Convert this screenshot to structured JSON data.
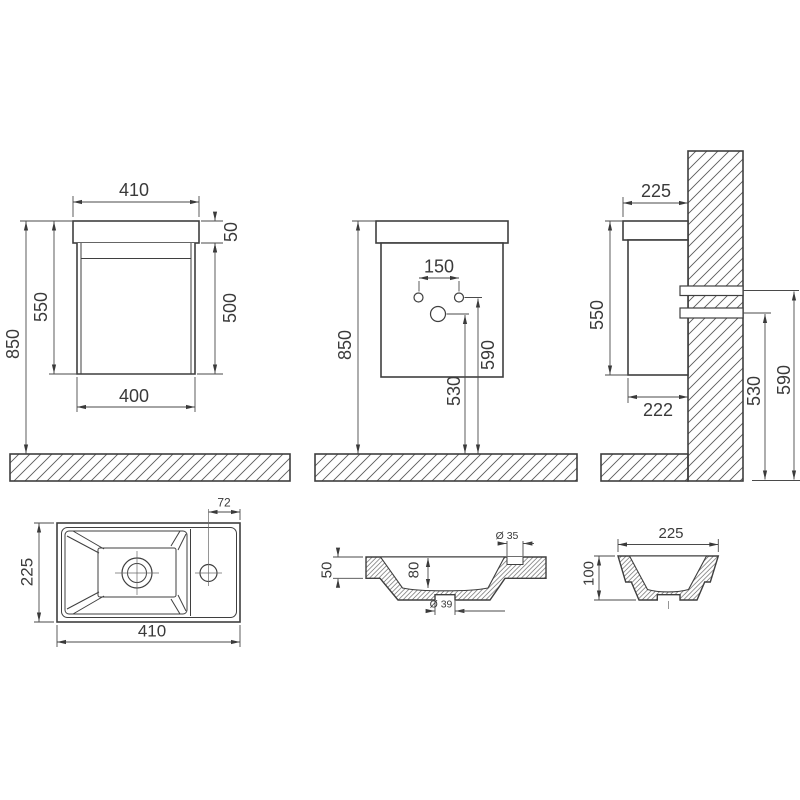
{
  "colors": {
    "line": "#3f3f3f",
    "dim_line": "#4a4a4a",
    "text": "#3a3a3a",
    "hatch": "#5a5a5a",
    "background": "#ffffff"
  },
  "views": {
    "front": {
      "top_width": "410",
      "worktop_height": "50",
      "cabinet_height": "550",
      "body_height": "500",
      "floor_to_top_height": "850",
      "body_width": "400"
    },
    "mounting": {
      "tap_hole_spacing": "150",
      "floor_to_top_height": "850",
      "drain_outlet_height": "530",
      "water_supply_height": "590"
    },
    "side": {
      "worktop_depth": "225",
      "cabinet_height": "550",
      "body_depth": "222",
      "drain_outlet_height": "530",
      "water_supply_height": "590"
    },
    "basin_top": {
      "tap_hole_offset": "72",
      "depth": "225",
      "width": "410"
    },
    "basin_front_section": {
      "rim_height": "50",
      "bowl_depth": "80",
      "tap_hole_diameter": "Ø 35",
      "drain_hole_diameter": "Ø 39"
    },
    "basin_side_section": {
      "depth": "225",
      "height": "100"
    }
  }
}
